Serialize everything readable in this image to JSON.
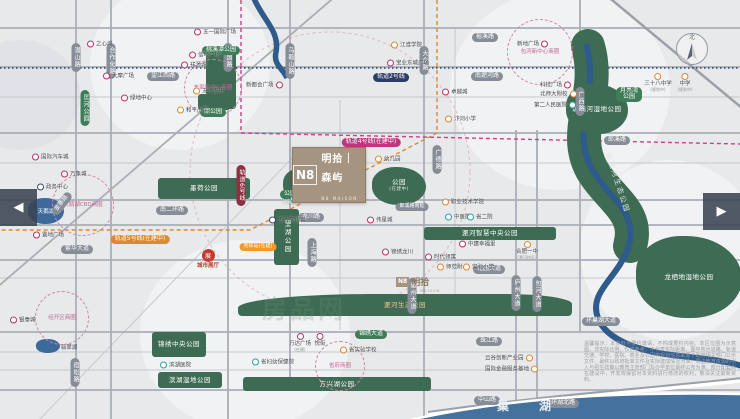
{
  "project": {
    "mark": "N8",
    "name": "明拾｜森屿",
    "sub": "N8 MAISON"
  },
  "project2": {
    "mark": "N8",
    "name": "明拾",
    "sub": "N8 MAISON"
  },
  "compass": {
    "north": "北"
  },
  "carousel": {
    "prev": "◀",
    "next": "▶"
  },
  "watermark": "房品网",
  "chaohu_label": "巢湖",
  "disclaimer": "温馨提示：本资料为要约邀请，不构成要约内容。本区位图为示意图，非实际比例，仅供参考，不代表实际距离。图中所示道路、轨道交通、学校、医院、商业及公园等规划信息来源于政府相关部门公示文件，最终以政府批准文件及实际建成情况为准。周边教育资源的引入与招生政策以教育主管部门及办学单位最终公布为准。部分配套尚在建设中，开发商保留对本资料进行修改的权利，敬请关注最新资料。",
  "colors": {
    "park": "#3e6b53",
    "water": "#3c6a9b",
    "mall": "#b5336b",
    "edu": "#dd8633",
    "med": "#2ba39e",
    "civic": "#3c4a68",
    "sales": "#c23a2f",
    "gray": "#868d97",
    "green": "#3f7d58",
    "navy": "#2c3e66",
    "magenta": "#c2347e",
    "orange": "#e0882f",
    "maroon": "#8e3040",
    "glow": "#f09a2e"
  },
  "parks": [
    {
      "t": "",
      "x": 206,
      "y": 47,
      "w": 30,
      "h": 62
    },
    {
      "t": "",
      "x": 198,
      "y": 94,
      "w": 32,
      "h": 16
    },
    {
      "t": "墨荷公园",
      "x": 158,
      "y": 178,
      "w": 92,
      "h": 21
    },
    {
      "t": "望湖公园",
      "x": 274,
      "y": 209,
      "w": 25,
      "h": 56,
      "vert": true
    },
    {
      "t": "",
      "x": 283,
      "y": 168,
      "w": 42,
      "h": 34,
      "blob": true
    },
    {
      "t": "公园",
      "sub": "(在建中)",
      "x": 372,
      "y": 167,
      "w": 54,
      "h": 38,
      "blob": true
    },
    {
      "t": "淝河智慧中央公园",
      "x": 424,
      "y": 227,
      "w": 132,
      "h": 13
    },
    {
      "t": "淝河生态公园",
      "x": 238,
      "y": 294,
      "w": 334,
      "h": 22,
      "tcolor": "#f2c690",
      "br": "40% 20% 4px 4px / 14px 10px 4px 4px"
    },
    {
      "t": "锦绣中央公园",
      "x": 152,
      "y": 332,
      "w": 54,
      "h": 25
    },
    {
      "t": "滨湖湿地公园",
      "x": 158,
      "y": 372,
      "w": 64,
      "h": 16
    },
    {
      "t": "方兴湖公园",
      "x": 243,
      "y": 377,
      "w": 188,
      "h": 14
    },
    {
      "t": "塘西河湿地公园",
      "x": 566,
      "y": 84,
      "w": 62,
      "h": 50,
      "blob": true
    },
    {
      "t": "龙栖地湿地公园",
      "x": 636,
      "y": 236,
      "w": 106,
      "h": 82,
      "blob": true
    }
  ],
  "corridor_label": {
    "t": "南淝河生态公园",
    "x": 586,
    "y": 178,
    "rot": 72
  },
  "lakes": [
    {
      "t": "天鹅湖",
      "x": 28,
      "y": 198,
      "w": 36,
      "h": 26,
      "inside": true
    },
    {
      "t": "翡翠湖",
      "x": 36,
      "y": 339,
      "w": 24,
      "h": 14,
      "inside": false
    }
  ],
  "pills": [
    {
      "t": "裕溪路",
      "x": 485,
      "y": 28,
      "c": "gray"
    },
    {
      "t": "望江西路",
      "x": 163,
      "y": 67,
      "c": "gray"
    },
    {
      "t": "南淝河路",
      "x": 487,
      "y": 67,
      "c": "gray"
    },
    {
      "t": "轨道2号线",
      "x": 391,
      "y": 68,
      "c": "navy"
    },
    {
      "t": "轨道4号线(在建中)",
      "x": 371,
      "y": 133,
      "c": "magenta"
    },
    {
      "t": "郎溪路",
      "x": 617,
      "y": 131,
      "c": "gray"
    },
    {
      "t": "轨道6号线",
      "x": 241,
      "y": 170,
      "c": "maroon",
      "v": true
    },
    {
      "t": "金寨路",
      "x": 58,
      "y": 196,
      "c": "gray",
      "r": -52
    },
    {
      "t": "南二环路",
      "x": 172,
      "y": 201,
      "c": "gray"
    },
    {
      "t": "郎溪路南延",
      "x": 412,
      "y": 197,
      "c": "gray",
      "fs": 5
    },
    {
      "t": "龙川路",
      "x": 311,
      "y": 208,
      "c": "gray"
    },
    {
      "t": "轨道5号线(在建中)",
      "x": 140,
      "y": 230,
      "c": "orange"
    },
    {
      "t": "地铁站(在建)",
      "x": 258,
      "y": 237,
      "c": "glow",
      "fs": 5
    },
    {
      "t": "繁华大道",
      "x": 77,
      "y": 240,
      "c": "gray"
    },
    {
      "t": "花园大道",
      "x": 489,
      "y": 260,
      "c": "gray"
    },
    {
      "t": "环巢湖大道",
      "x": 601,
      "y": 312,
      "c": "gray"
    },
    {
      "t": "锦绣大道",
      "x": 371,
      "y": 325,
      "c": "green"
    },
    {
      "t": "珠江路",
      "x": 489,
      "y": 332,
      "c": "gray"
    },
    {
      "t": "中山路",
      "x": 487,
      "y": 391,
      "c": "gray"
    },
    {
      "t": "环湖北路",
      "x": 563,
      "y": 394,
      "c": "gray"
    },
    {
      "t": "潜山路",
      "x": 76,
      "y": 48,
      "c": "gray",
      "v": true
    },
    {
      "t": "合作化路",
      "x": 111,
      "y": 48,
      "c": "gray",
      "v": true
    },
    {
      "t": "宁国路",
      "x": 228,
      "y": 48,
      "c": "gray",
      "v": true
    },
    {
      "t": "马鞍山路",
      "x": 290,
      "y": 48,
      "c": "gray",
      "v": true
    },
    {
      "t": "大众路",
      "x": 424,
      "y": 51,
      "c": "gray",
      "v": true
    },
    {
      "t": "广德路",
      "x": 437,
      "y": 150,
      "c": "gray",
      "v": true
    },
    {
      "t": "上海路",
      "x": 312,
      "y": 243,
      "c": "gray",
      "v": true
    },
    {
      "t": "徽州大道",
      "x": 412,
      "y": 283,
      "c": "gray",
      "v": true
    },
    {
      "t": "庐州大道",
      "x": 516,
      "y": 280,
      "c": "gray",
      "v": true
    },
    {
      "t": "包河大道",
      "x": 537,
      "y": 281,
      "c": "gray",
      "v": true
    },
    {
      "t": "广西路",
      "x": 580,
      "y": 92,
      "c": "gray",
      "v": true
    },
    {
      "t": "宿松路",
      "x": 75,
      "y": 363,
      "c": "gray",
      "v": true
    },
    {
      "t": "匡河公园",
      "x": 85,
      "y": 95,
      "c": "green",
      "v": true
    },
    {
      "t": "桃溪潭公园",
      "x": 221,
      "y": 41,
      "c": "green"
    },
    {
      "t": "熙公园",
      "x": 213,
      "y": 103,
      "c": "green"
    },
    {
      "t": "月亮湾|公园",
      "x": 629,
      "y": 88,
      "c": "green"
    },
    {
      "t": "公园",
      "sub": "(在建中)",
      "x": 290,
      "y": 185,
      "c": "green"
    }
  ],
  "business_circles": [
    {
      "t": "东部新中心商圈",
      "x": 213,
      "y": 88,
      "r": 26
    },
    {
      "t": "包河新中心商圈",
      "x": 540,
      "y": 52,
      "r": 30
    },
    {
      "t": "天鹅湖CBD商圈",
      "x": 83,
      "y": 205,
      "r": 28
    },
    {
      "t": "经开区商圈",
      "x": 62,
      "y": 318,
      "r": 24
    },
    {
      "t": "省府商圈",
      "x": 340,
      "y": 366,
      "r": 22
    }
  ],
  "pois": [
    {
      "t": "之心城",
      "x": 90,
      "y": 44,
      "k": "mall"
    },
    {
      "t": "大摩广场",
      "x": 106,
      "y": 76,
      "k": "mall"
    },
    {
      "t": "绿地中心",
      "x": 124,
      "y": 98,
      "k": "mall"
    },
    {
      "t": "国际汽车城",
      "x": 35,
      "y": 157,
      "k": "mall"
    },
    {
      "t": "万象城",
      "x": 64,
      "y": 174,
      "k": "mall"
    },
    {
      "t": "政务中心",
      "x": 40,
      "y": 187,
      "k": "civic"
    },
    {
      "t": "置地广场",
      "x": 36,
      "y": 235,
      "k": "mall"
    },
    {
      "t": "银泰城",
      "x": 13,
      "y": 320,
      "k": "mall"
    },
    {
      "t": "五一国际广场",
      "x": 197,
      "y": 32,
      "k": "mall"
    },
    {
      "t": "信地广场",
      "x": 192,
      "y": 55,
      "k": "mall"
    },
    {
      "t": "祥源城",
      "x": 184,
      "y": 65,
      "k": "mall"
    },
    {
      "t": "五十五中",
      "x": 196,
      "y": 91,
      "k": "edu"
    },
    {
      "t": "和平小学",
      "x": 180,
      "y": 110,
      "k": "edu"
    },
    {
      "t": "新都会广场",
      "x": 249,
      "y": 85,
      "k": "mall",
      "side": "l"
    },
    {
      "t": "江淮学院",
      "x": 394,
      "y": 45,
      "k": "edu"
    },
    {
      "t": "宝业东城广场",
      "x": 390,
      "y": 63,
      "k": "mall"
    },
    {
      "t": "卓越城",
      "x": 445,
      "y": 92,
      "k": "mall"
    },
    {
      "t": "汴河小学",
      "x": 448,
      "y": 119,
      "k": "edu"
    },
    {
      "t": "新地广场",
      "x": 520,
      "y": 44,
      "k": "mall",
      "side": "l"
    },
    {
      "t": "科技广场",
      "x": 543,
      "y": 85,
      "k": "mall",
      "side": "l"
    },
    {
      "t": "北师大附校",
      "x": 543,
      "y": 94,
      "k": "edu",
      "side": "l"
    },
    {
      "t": "第二人民医院",
      "x": 537,
      "y": 105,
      "k": "med",
      "side": "l"
    },
    {
      "t": "三十八中学",
      "sub": "(规划中)",
      "x": 658,
      "y": 77,
      "k": "edu",
      "side": "b"
    },
    {
      "t": "中学",
      "sub": "(规划中)",
      "x": 685,
      "y": 77,
      "k": "edu",
      "side": "b"
    },
    {
      "t": "幼儿园",
      "x": 378,
      "y": 159,
      "k": "edu"
    },
    {
      "t": "工人文化宫",
      "x": 272,
      "y": 220,
      "k": "civic"
    },
    {
      "t": "安徽医学高等专科学校",
      "x": 293,
      "y": 199,
      "k": "med"
    },
    {
      "t": "伟星城",
      "x": 370,
      "y": 220,
      "k": "mall"
    },
    {
      "t": "城市展厅",
      "x": 208,
      "y": 253,
      "k": "sales",
      "side": "b",
      "glyph": "展"
    },
    {
      "t": "锦绣龙川",
      "x": 385,
      "y": 252,
      "k": "mall"
    },
    {
      "t": "时代领寓",
      "x": 428,
      "y": 257,
      "k": "mall"
    },
    {
      "t": "中建幸福里",
      "x": 462,
      "y": 244,
      "k": "mall"
    },
    {
      "t": "中医院",
      "x": 448,
      "y": 217,
      "k": "med"
    },
    {
      "t": "省二院",
      "x": 470,
      "y": 217,
      "k": "med"
    },
    {
      "t": "职业技术学院",
      "x": 445,
      "y": 202,
      "k": "edu"
    },
    {
      "t": "合肥一中",
      "sub": "(淝河校区)",
      "x": 527,
      "y": 245,
      "k": "edu",
      "side": "b"
    },
    {
      "t": "师范附小",
      "x": 440,
      "y": 267,
      "k": "edu"
    },
    {
      "t": "实验小学",
      "x": 466,
      "y": 267,
      "k": "edu"
    },
    {
      "t": "万达广场",
      "sub": "(在建)",
      "x": 300,
      "y": 337,
      "k": "mall",
      "side": "b"
    },
    {
      "t": "悦街",
      "x": 320,
      "y": 337,
      "k": "mall",
      "side": "b"
    },
    {
      "t": "省实验学校",
      "x": 343,
      "y": 350,
      "k": "edu"
    },
    {
      "t": "省妇幼保健院",
      "x": 255,
      "y": 362,
      "k": "med"
    },
    {
      "t": "滨湖医院",
      "x": 163,
      "y": 365,
      "k": "med"
    },
    {
      "t": "云谷创新产业园",
      "x": 488,
      "y": 358,
      "k": "edu",
      "side": "l"
    },
    {
      "t": "国际金融服务基地",
      "x": 488,
      "y": 369,
      "k": "edu",
      "side": "l"
    }
  ]
}
